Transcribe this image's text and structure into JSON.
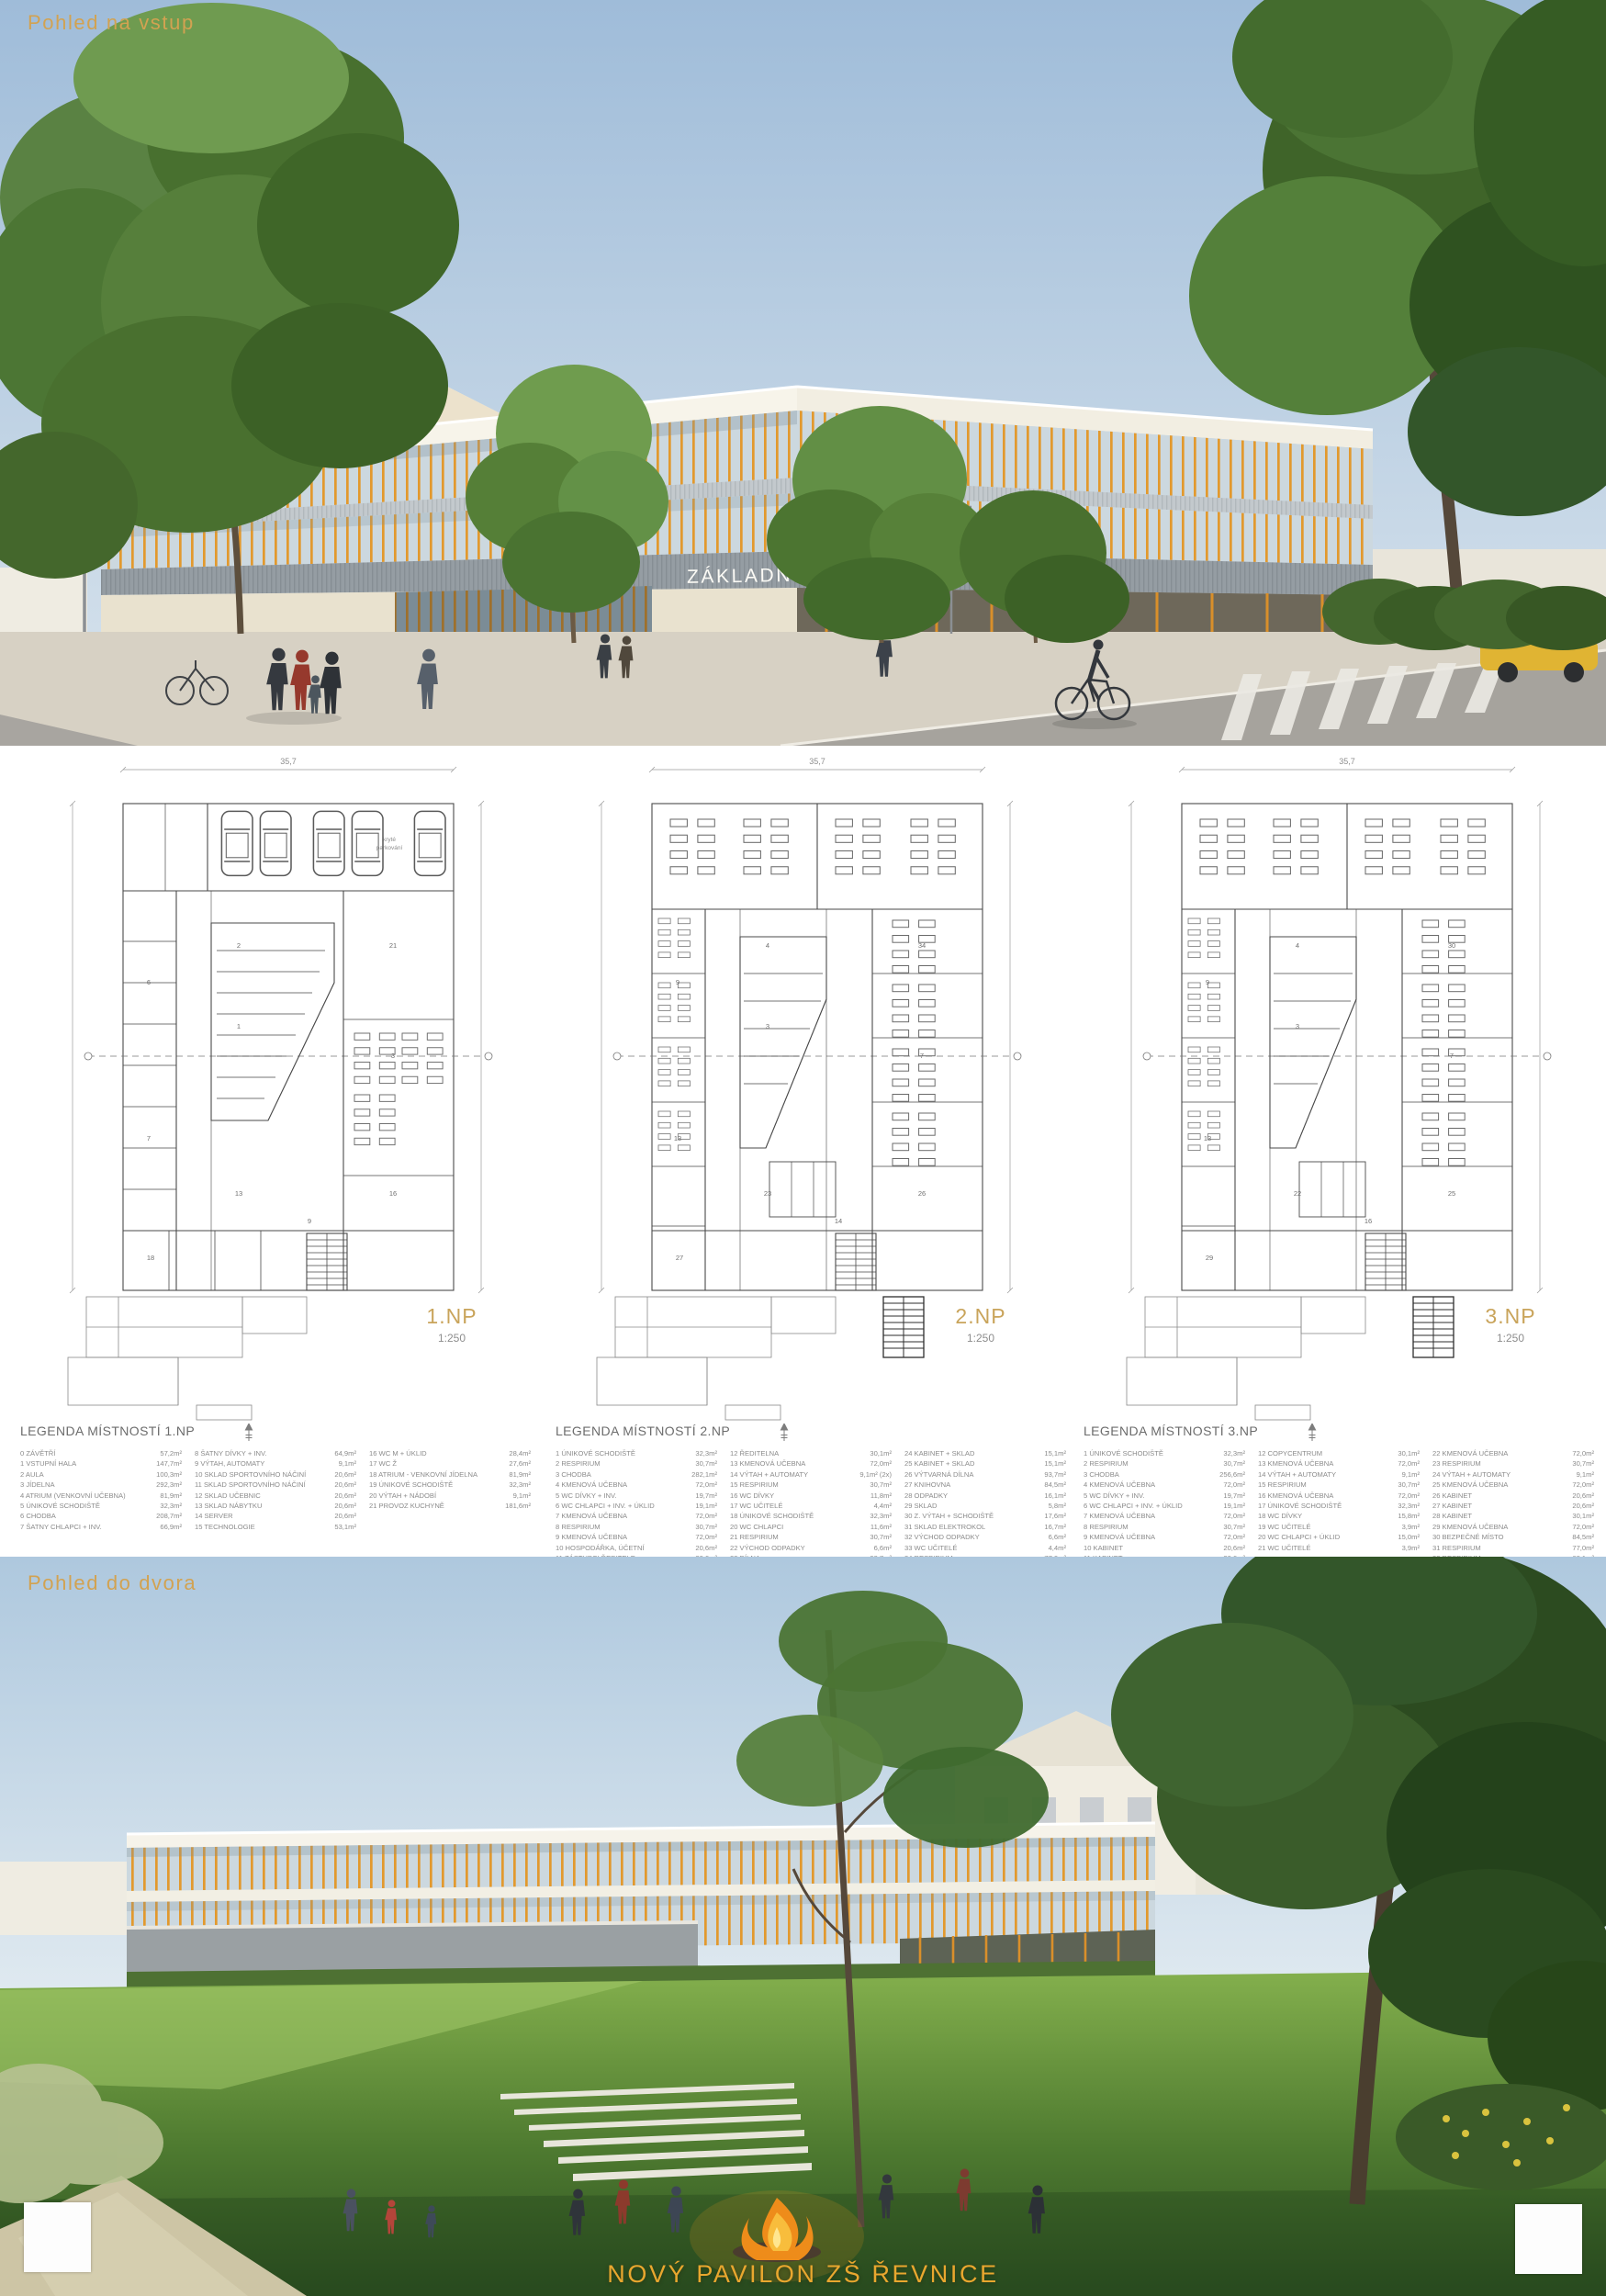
{
  "poster": {
    "top_view_title": "Pohled na vstup",
    "bottom_view_title": "Pohled do dvora",
    "building_sign": "ZÁKLADNÍ ŠKOLA ŘEVNICE",
    "footer_title": "NOVÝ PAVILON ZŠ ŘEVNICE"
  },
  "colors": {
    "accent_gold": "#D2A251",
    "mullion_orange": "#E2992E",
    "plan_label_gold": "#C9A45B",
    "legend_text": "#8B8B8B"
  },
  "plans": [
    {
      "label": "1.NP",
      "scale": "1:250",
      "dimension_width": "35,7",
      "parking_label_line1": "kryté",
      "parking_label_line2": "parkování",
      "legend_title": "LEGENDA MÍSTNOSTÍ 1.NP",
      "room_numbers": [
        "1",
        "2",
        "3",
        "6",
        "7",
        "13",
        "16",
        "18",
        "21",
        "9"
      ],
      "legend_columns": [
        [
          [
            "0 ZÁVĚTŘÍ",
            "57,2m²"
          ],
          [
            "1 VSTUPNÍ HALA",
            "147,7m²"
          ],
          [
            "2 AULA",
            "100,3m²"
          ],
          [
            "3 JÍDELNA",
            "292,3m²"
          ],
          [
            "4 ATRIUM (VENKOVNÍ UČEBNA)",
            "81,9m²"
          ],
          [
            "5 ÚNIKOVÉ SCHODIŠTĚ",
            "32,3m²"
          ],
          [
            "6 CHODBA",
            "208,7m²"
          ],
          [
            "7 ŠATNY CHLAPCI + INV.",
            "66,9m²"
          ]
        ],
        [
          [
            "8 ŠATNY DÍVKY + INV.",
            "64,9m²"
          ],
          [
            "9 VÝTAH, AUTOMATY",
            "9,1m²"
          ],
          [
            "10 SKLAD SPORTOVNÍHO NÁČINÍ",
            "20,6m²"
          ],
          [
            "11 SKLAD SPORTOVNÍHO NÁČINÍ",
            "20,6m²"
          ],
          [
            "12 SKLAD UČEBNIC",
            "20,6m²"
          ],
          [
            "13 SKLAD NÁBYTKU",
            "20,6m²"
          ],
          [
            "14 SERVER",
            "20,6m²"
          ],
          [
            "15 TECHNOLOGIE",
            "53,1m²"
          ]
        ],
        [
          [
            "16 WC M + ÚKLID",
            "28,4m²"
          ],
          [
            "17 WC Ž",
            "27,6m²"
          ],
          [
            "18 ATRIUM - VENKOVNÍ JÍDELNA",
            "81,9m²"
          ],
          [
            "19 ÚNIKOVÉ SCHODIŠTĚ",
            "32,3m²"
          ],
          [
            "20 VÝTAH + NÁDOBÍ",
            "9,1m²"
          ],
          [
            "21 PROVOZ KUCHYNĚ",
            "181,6m²"
          ]
        ]
      ]
    },
    {
      "label": "2.NP",
      "scale": "1:250",
      "dimension_width": "35,7",
      "legend_title": "LEGENDA MÍSTNOSTÍ 2.NP",
      "room_numbers": [
        "3",
        "4",
        "7",
        "9",
        "13",
        "23",
        "26",
        "27",
        "34",
        "14"
      ],
      "legend_columns": [
        [
          [
            "1 ÚNIKOVÉ SCHODIŠTĚ",
            "32,3m²"
          ],
          [
            "2 RESPIRIUM",
            "30,7m²"
          ],
          [
            "3 CHODBA",
            "282,1m²"
          ],
          [
            "4 KMENOVÁ UČEBNA",
            "72,0m²"
          ],
          [
            "5 WC DÍVKY + INV.",
            "19,7m²"
          ],
          [
            "6 WC CHLAPCI + INV. + ÚKLID",
            "19,1m²"
          ],
          [
            "7 KMENOVÁ UČEBNA",
            "72,0m²"
          ],
          [
            "8 RESPIRIUM",
            "30,7m²"
          ],
          [
            "9 KMENOVÁ UČEBNA",
            "72,0m²"
          ],
          [
            "10 HOSPODÁŘKA, ÚČETNÍ",
            "20,6m²"
          ],
          [
            "11 ZÁSTUPCI ŘEDITELE",
            "20,6m²"
          ]
        ],
        [
          [
            "12 ŘEDITELNA",
            "30,1m²"
          ],
          [
            "13 KMENOVÁ UČEBNA",
            "72,0m²"
          ],
          [
            "14 VÝTAH + AUTOMATY",
            "9,1m² (2x)"
          ],
          [
            "15 RESPIRIUM",
            "30,7m²"
          ],
          [
            "16 WC DÍVKY",
            "11,8m²"
          ],
          [
            "17 WC UČITELÉ",
            "4,4m²"
          ],
          [
            "18 ÚNIKOVÉ SCHODIŠTĚ",
            "32,3m²"
          ],
          [
            "20 WC CHLAPCI",
            "11,6m²"
          ],
          [
            "21 RESPIRIUM",
            "30,7m²"
          ],
          [
            "22 VÝCHOD ODPADKY",
            "6,6m²"
          ],
          [
            "23 DÍLNA",
            "93,7m²"
          ]
        ],
        [
          [
            "24 KABINET + SKLAD",
            "15,1m²"
          ],
          [
            "25 KABINET + SKLAD",
            "15,1m²"
          ],
          [
            "26 VÝTVARNÁ DÍLNA",
            "93,7m²"
          ],
          [
            "27 KNIHOVNA",
            "84,5m²"
          ],
          [
            "28 ODPADKY",
            "16,1m²"
          ],
          [
            "29 SKLAD",
            "5,8m²"
          ],
          [
            "30 Z. VÝTAH + SCHODIŠTĚ",
            "17,6m²"
          ],
          [
            "31 SKLAD ELEKTROKOL",
            "16,7m²"
          ],
          [
            "32 VÝCHOD ODPADKY",
            "6,6m²"
          ],
          [
            "33 WC UČITELÉ",
            "4,4m²"
          ],
          [
            "34 RESPIRIUM",
            "77,0m²"
          ]
        ]
      ]
    },
    {
      "label": "3.NP",
      "scale": "1:250",
      "dimension_width": "35,7",
      "legend_title": "LEGENDA MÍSTNOSTÍ 3.NP",
      "room_numbers": [
        "3",
        "4",
        "7",
        "9",
        "13",
        "22",
        "25",
        "29",
        "30",
        "16"
      ],
      "legend_columns": [
        [
          [
            "1 ÚNIKOVÉ SCHODIŠTĚ",
            "32,3m²"
          ],
          [
            "2 RESPIRIUM",
            "30,7m²"
          ],
          [
            "3 CHODBA",
            "256,6m²"
          ],
          [
            "4 KMENOVÁ UČEBNA",
            "72,0m²"
          ],
          [
            "5 WC DÍVKY + INV.",
            "19,7m²"
          ],
          [
            "6 WC CHLAPCI + INV. + ÚKLID",
            "19,1m²"
          ],
          [
            "7 KMENOVÁ UČEBNA",
            "72,0m²"
          ],
          [
            "8 RESPIRIUM",
            "30,7m²"
          ],
          [
            "9 KMENOVÁ UČEBNA",
            "72,0m²"
          ],
          [
            "10 KABINET",
            "20,6m²"
          ],
          [
            "11 KABINET",
            "20,6m²"
          ]
        ],
        [
          [
            "12 COPYCENTRUM",
            "30,1m²"
          ],
          [
            "13 KMENOVÁ UČEBNA",
            "72,0m²"
          ],
          [
            "14 VÝTAH + AUTOMATY",
            "9,1m²"
          ],
          [
            "15 RESPIRIUM",
            "30,7m²"
          ],
          [
            "16 KMENOVÁ UČEBNA",
            "72,0m²"
          ],
          [
            "17 ÚNIKOVÉ SCHODIŠTĚ",
            "32,3m²"
          ],
          [
            "18 WC DÍVKY",
            "15,8m²"
          ],
          [
            "19 WC UČITELÉ",
            "3,9m²"
          ],
          [
            "20 WC CHLAPCI + ÚKLID",
            "15,0m²"
          ],
          [
            "21 WC UČITELÉ",
            "3,9m²"
          ]
        ],
        [
          [
            "22 KMENOVÁ UČEBNA",
            "72,0m²"
          ],
          [
            "23 RESPIRIUM",
            "30,7m²"
          ],
          [
            "24 VÝTAH + AUTOMATY",
            "9,1m²"
          ],
          [
            "25 KMENOVÁ UČEBNA",
            "72,0m²"
          ],
          [
            "26 KABINET",
            "20,6m²"
          ],
          [
            "27 KABINET",
            "20,6m²"
          ],
          [
            "28 KABINET",
            "30,1m²"
          ],
          [
            "29 KMENOVÁ UČEBNA",
            "72,0m²"
          ],
          [
            "30 BEZPEČNÉ MÍSTO",
            "84,5m²"
          ],
          [
            "31 RESPIRIUM",
            "77,0m²"
          ],
          [
            "32 RESPIRIUM",
            "68,1m²"
          ]
        ]
      ]
    }
  ]
}
